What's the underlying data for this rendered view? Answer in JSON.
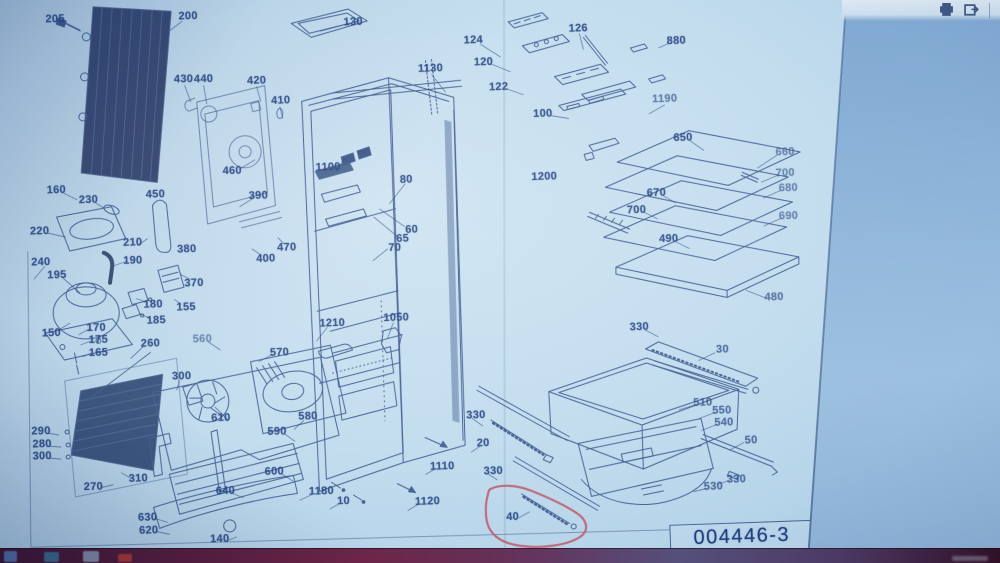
{
  "viewer": {
    "toolbar": {
      "icons": [
        {
          "name": "print-icon"
        },
        {
          "name": "export-icon"
        }
      ]
    }
  },
  "page": {
    "drawing_number": "004446-3",
    "paper_color": "#c2dcee",
    "line_color": "#2b4983"
  },
  "annotation": {
    "type": "freehand-circle",
    "color": "#c4576a",
    "around_part": "40"
  },
  "diagram": {
    "labels": [
      {
        "t": "205",
        "x": 57,
        "y": 16
      },
      {
        "t": "200",
        "x": 190,
        "y": 14
      },
      {
        "t": "130",
        "x": 355,
        "y": 21
      },
      {
        "t": "1130",
        "x": 432,
        "y": 68
      },
      {
        "t": "430",
        "x": 185,
        "y": 77
      },
      {
        "t": "440",
        "x": 205,
        "y": 77
      },
      {
        "t": "420",
        "x": 258,
        "y": 79
      },
      {
        "t": "410",
        "x": 282,
        "y": 99
      },
      {
        "t": "460",
        "x": 233,
        "y": 169
      },
      {
        "t": "124",
        "x": 475,
        "y": 40
      },
      {
        "t": "120",
        "x": 485,
        "y": 62
      },
      {
        "t": "122",
        "x": 500,
        "y": 87
      },
      {
        "t": "126",
        "x": 580,
        "y": 29
      },
      {
        "t": "880",
        "x": 678,
        "y": 42
      },
      {
        "t": "1190",
        "x": 666,
        "y": 100,
        "o": 0.65
      },
      {
        "t": "100",
        "x": 544,
        "y": 114
      },
      {
        "t": "1200",
        "x": 545,
        "y": 177
      },
      {
        "t": "160",
        "x": 57,
        "y": 187
      },
      {
        "t": "230",
        "x": 89,
        "y": 197
      },
      {
        "t": "220",
        "x": 40,
        "y": 228
      },
      {
        "t": "450",
        "x": 156,
        "y": 192
      },
      {
        "t": "210",
        "x": 133,
        "y": 240
      },
      {
        "t": "190",
        "x": 133,
        "y": 258
      },
      {
        "t": "240",
        "x": 41,
        "y": 259
      },
      {
        "t": "195",
        "x": 57,
        "y": 272
      },
      {
        "t": "380",
        "x": 187,
        "y": 247
      },
      {
        "t": "390",
        "x": 259,
        "y": 194
      },
      {
        "t": "470",
        "x": 287,
        "y": 246
      },
      {
        "t": "400",
        "x": 266,
        "y": 257
      },
      {
        "t": "370",
        "x": 194,
        "y": 281
      },
      {
        "t": "180",
        "x": 153,
        "y": 302
      },
      {
        "t": "155",
        "x": 186,
        "y": 305
      },
      {
        "t": "185",
        "x": 156,
        "y": 318
      },
      {
        "t": "150",
        "x": 51,
        "y": 330
      },
      {
        "t": "170",
        "x": 96,
        "y": 325
      },
      {
        "t": "175",
        "x": 98,
        "y": 337
      },
      {
        "t": "165",
        "x": 98,
        "y": 350
      },
      {
        "t": "260",
        "x": 150,
        "y": 341
      },
      {
        "t": "300",
        "x": 181,
        "y": 374
      },
      {
        "t": "560",
        "x": 202,
        "y": 337,
        "o": 0.55
      },
      {
        "t": "570",
        "x": 279,
        "y": 351
      },
      {
        "t": "1210",
        "x": 332,
        "y": 322
      },
      {
        "t": "1050",
        "x": 396,
        "y": 317
      },
      {
        "t": "1100",
        "x": 329,
        "y": 166
      },
      {
        "t": "80",
        "x": 407,
        "y": 179
      },
      {
        "t": "60",
        "x": 412,
        "y": 229
      },
      {
        "t": "65",
        "x": 403,
        "y": 238
      },
      {
        "t": "70",
        "x": 395,
        "y": 247
      },
      {
        "t": "610",
        "x": 220,
        "y": 416
      },
      {
        "t": "590",
        "x": 276,
        "y": 430
      },
      {
        "t": "580",
        "x": 307,
        "y": 415
      },
      {
        "t": "600",
        "x": 273,
        "y": 470
      },
      {
        "t": "640",
        "x": 224,
        "y": 489
      },
      {
        "t": "630",
        "x": 146,
        "y": 515
      },
      {
        "t": "620",
        "x": 147,
        "y": 528
      },
      {
        "t": "140",
        "x": 218,
        "y": 537
      },
      {
        "t": "290",
        "x": 40,
        "y": 428
      },
      {
        "t": "280",
        "x": 41,
        "y": 441
      },
      {
        "t": "300",
        "x": 41,
        "y": 453
      },
      {
        "t": "270",
        "x": 92,
        "y": 484
      },
      {
        "t": "310",
        "x": 137,
        "y": 476
      },
      {
        "t": "1180",
        "x": 320,
        "y": 490
      },
      {
        "t": "10",
        "x": 342,
        "y": 500
      },
      {
        "t": "1120",
        "x": 426,
        "y": 501
      },
      {
        "t": "1110",
        "x": 441,
        "y": 466
      },
      {
        "t": "330",
        "x": 475,
        "y": 415
      },
      {
        "t": "20",
        "x": 482,
        "y": 443
      },
      {
        "t": "330",
        "x": 492,
        "y": 471
      },
      {
        "t": "40",
        "x": 511,
        "y": 517
      },
      {
        "t": "330",
        "x": 639,
        "y": 328
      },
      {
        "t": "30",
        "x": 722,
        "y": 351,
        "o": 0.75
      },
      {
        "t": "510",
        "x": 702,
        "y": 404,
        "o": 0.75
      },
      {
        "t": "550",
        "x": 721,
        "y": 412,
        "o": 0.75
      },
      {
        "t": "540",
        "x": 723,
        "y": 424,
        "o": 0.75
      },
      {
        "t": "50",
        "x": 750,
        "y": 442,
        "o": 0.75
      },
      {
        "t": "330",
        "x": 735,
        "y": 481,
        "o": 0.75
      },
      {
        "t": "530",
        "x": 712,
        "y": 488,
        "o": 0.75
      },
      {
        "t": "650",
        "x": 684,
        "y": 139
      },
      {
        "t": "660",
        "x": 786,
        "y": 154,
        "o": 0.6
      },
      {
        "t": "700",
        "x": 786,
        "y": 175,
        "o": 0.6
      },
      {
        "t": "680",
        "x": 789,
        "y": 190,
        "o": 0.6
      },
      {
        "t": "690",
        "x": 789,
        "y": 218,
        "o": 0.6
      },
      {
        "t": "670",
        "x": 657,
        "y": 194
      },
      {
        "t": "700",
        "x": 637,
        "y": 211
      },
      {
        "t": "490",
        "x": 669,
        "y": 240
      },
      {
        "t": "480",
        "x": 774,
        "y": 299,
        "o": 0.7
      }
    ]
  },
  "taskbar": {
    "background": "#5a1f3d",
    "icons": [
      {
        "name": "taskbar-app-icon-1",
        "x": 4,
        "y": 551,
        "w": 13,
        "h": 11,
        "color": "#5b87c0"
      },
      {
        "name": "taskbar-app-icon-2",
        "x": 44,
        "y": 552,
        "w": 15,
        "h": 10,
        "color": "#3e7da0"
      },
      {
        "name": "taskbar-app-icon-3",
        "x": 83,
        "y": 551,
        "w": 16,
        "h": 11,
        "color": "#93a7bd"
      },
      {
        "name": "taskbar-app-icon-4",
        "x": 118,
        "y": 554,
        "w": 14,
        "h": 8,
        "color": "#c23a30"
      }
    ]
  }
}
